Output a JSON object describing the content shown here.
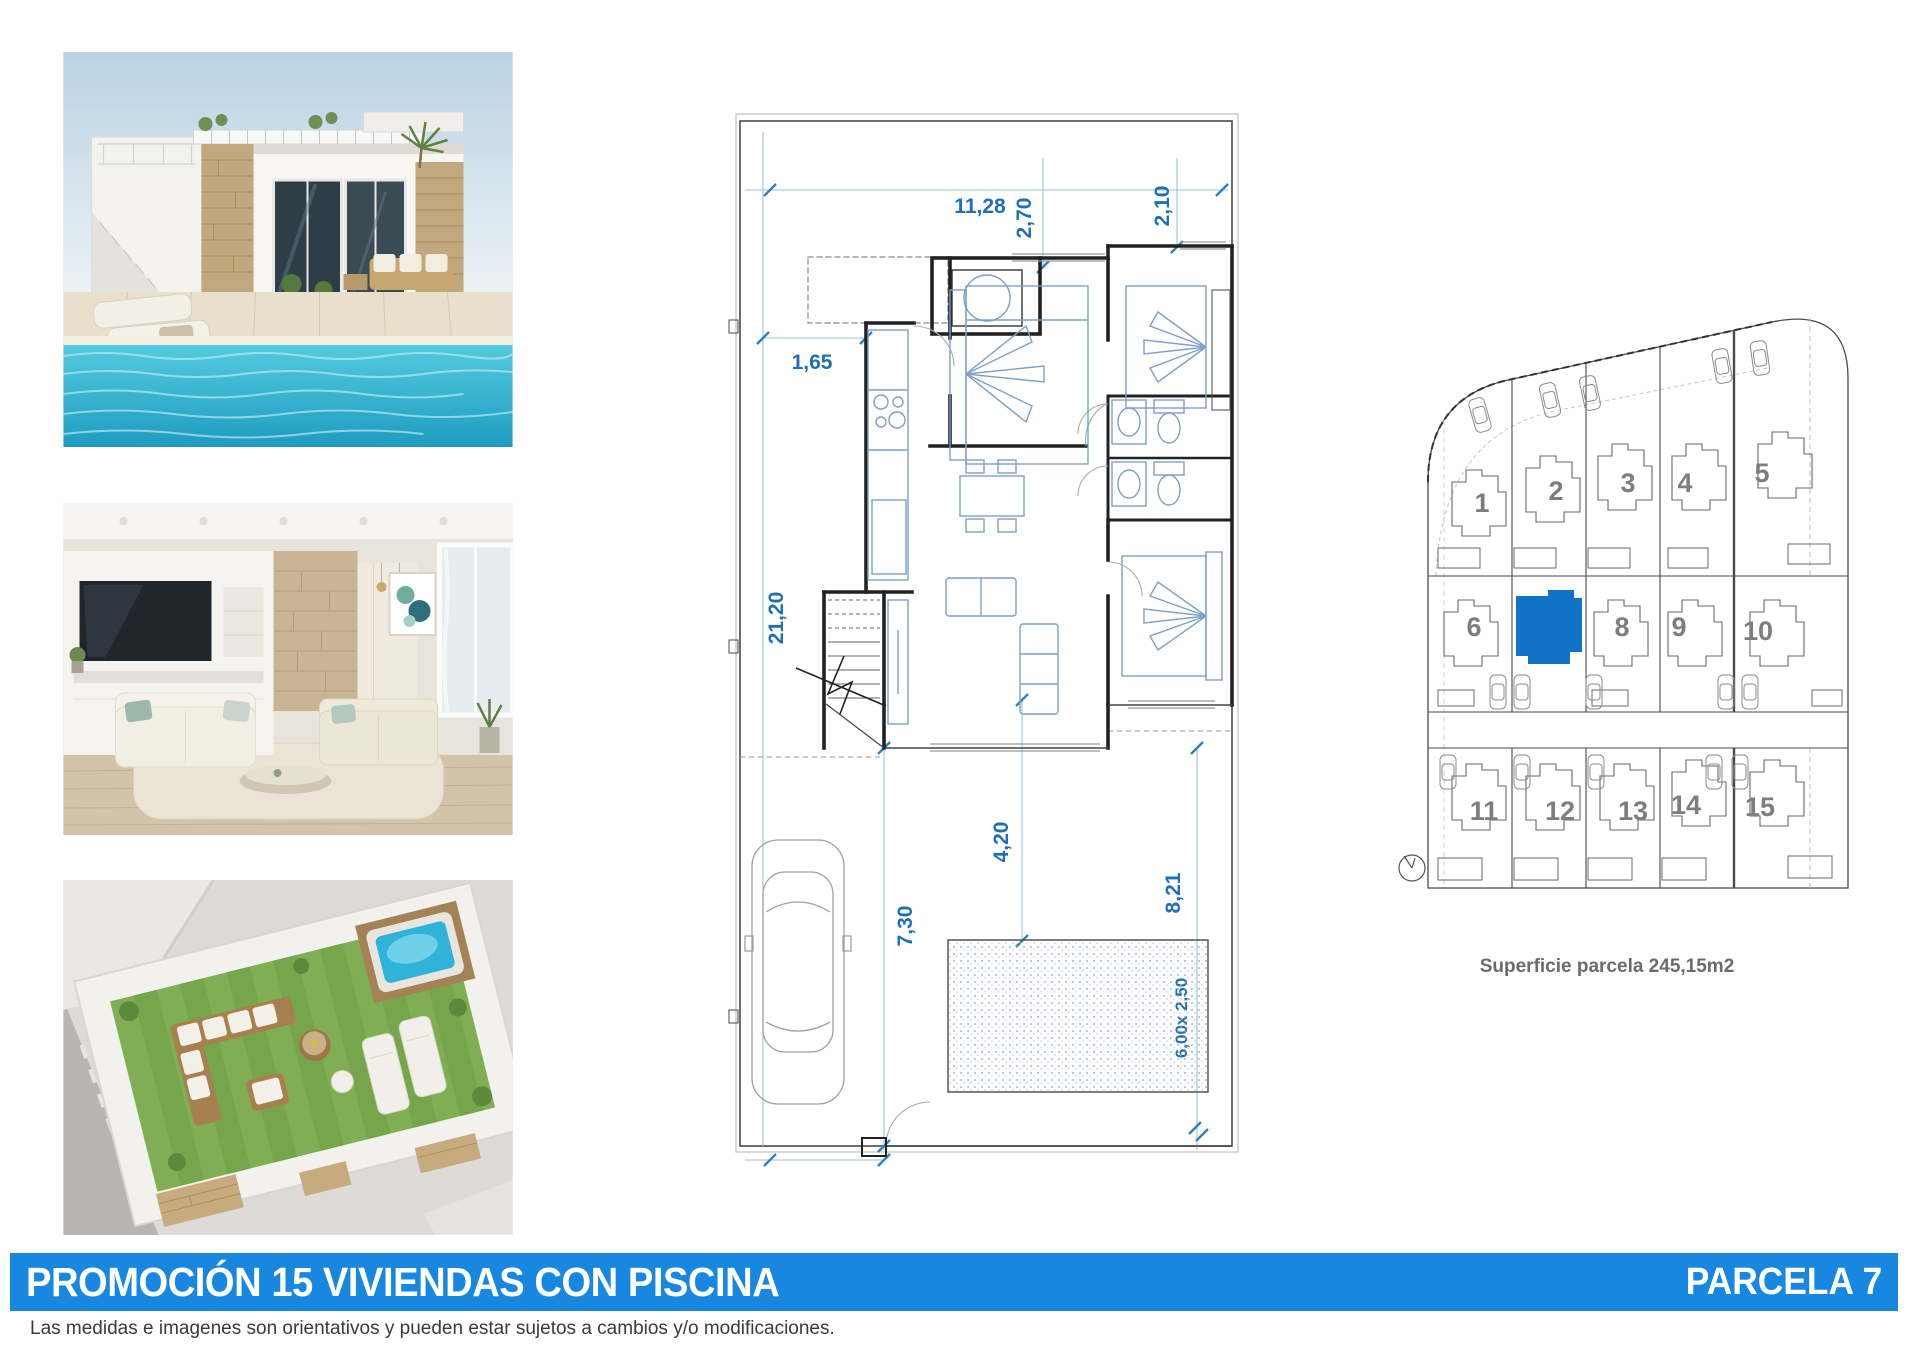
{
  "title_banner": {
    "left_text": "PROMOCIÓN 15 VIVIENDAS CON PISCINA",
    "right_text": "PARCELA 7"
  },
  "disclaimer": "Las medidas e imagenes son orientativos y pueden estar sujetos a cambios y/o modificaciones.",
  "floorplan": {
    "dimensions": [
      {
        "name": "plot-width-top",
        "value": "11,28"
      },
      {
        "name": "setback-top-center",
        "value": "2,70"
      },
      {
        "name": "setback-top-right",
        "value": "2,10"
      },
      {
        "name": "setback-left",
        "value": "1,65"
      },
      {
        "name": "plot-depth-left",
        "value": "21,20"
      },
      {
        "name": "terrace-depth",
        "value": "4,20"
      },
      {
        "name": "driveway-depth",
        "value": "7,30"
      },
      {
        "name": "garden-depth-right",
        "value": "8,21"
      },
      {
        "name": "pool-size",
        "value": "6,00x 2,50"
      },
      {
        "name": "driveway-width-bottom",
        "value": "3,00"
      }
    ]
  },
  "siteplan": {
    "caption": "Superficie parcela 245,15m2",
    "plots": [
      {
        "number": "1"
      },
      {
        "number": "2"
      },
      {
        "number": "3"
      },
      {
        "number": "4"
      },
      {
        "number": "5"
      },
      {
        "number": "6"
      },
      {
        "number": "",
        "highlighted": true
      },
      {
        "number": "8"
      },
      {
        "number": "9"
      },
      {
        "number": "10"
      },
      {
        "number": "11"
      },
      {
        "number": "12"
      },
      {
        "number": "13"
      },
      {
        "number": "14"
      },
      {
        "number": "15"
      }
    ]
  },
  "colors": {
    "banner_blue": "#1787e0",
    "dimension_blue": "#1e6fb5",
    "highlight_plot_blue": "#1272c8"
  }
}
